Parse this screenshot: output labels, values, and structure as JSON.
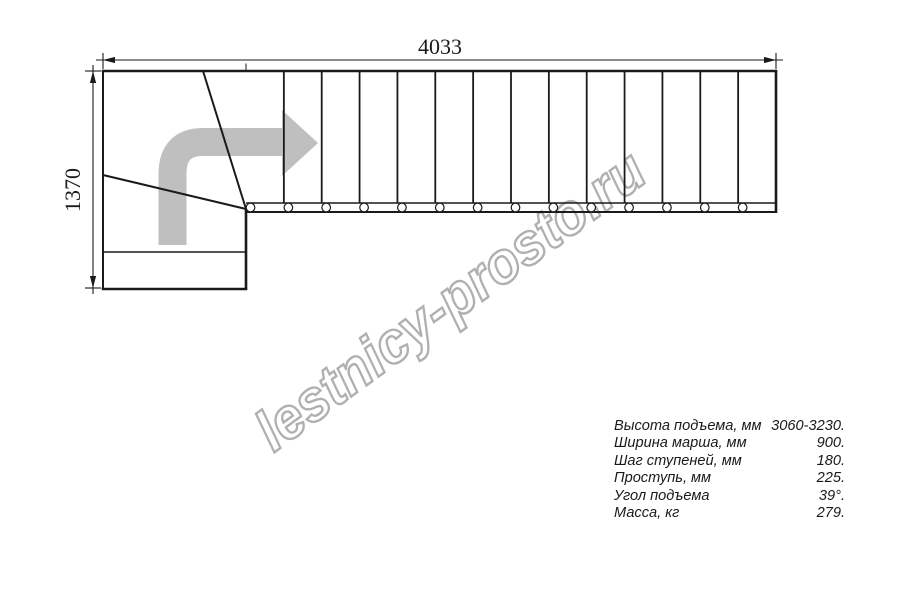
{
  "drawing": {
    "type": "staircase-plan-top-view",
    "total_length_label": "4033",
    "total_width_label": "1370",
    "straight_treads": 14,
    "winder_treads": 3,
    "direction_arrow": "up-then-right",
    "colors": {
      "line": "#1a1a1a",
      "arrow": "#bfbfbf",
      "watermark": "#b0b0b0"
    }
  },
  "specs": {
    "rows": [
      {
        "label": "Высота подъема, мм",
        "value": "3060-3230."
      },
      {
        "label": "Ширина марша, мм",
        "value": "900."
      },
      {
        "label": "Шаг ступеней, мм",
        "value": "180."
      },
      {
        "label": "Проступь, мм",
        "value": "225."
      },
      {
        "label": "Угол подъема",
        "value": "39°."
      },
      {
        "label": "Масса, кг",
        "value": "279."
      }
    ]
  },
  "watermark": {
    "text": "lestnicy-prosto.ru"
  }
}
